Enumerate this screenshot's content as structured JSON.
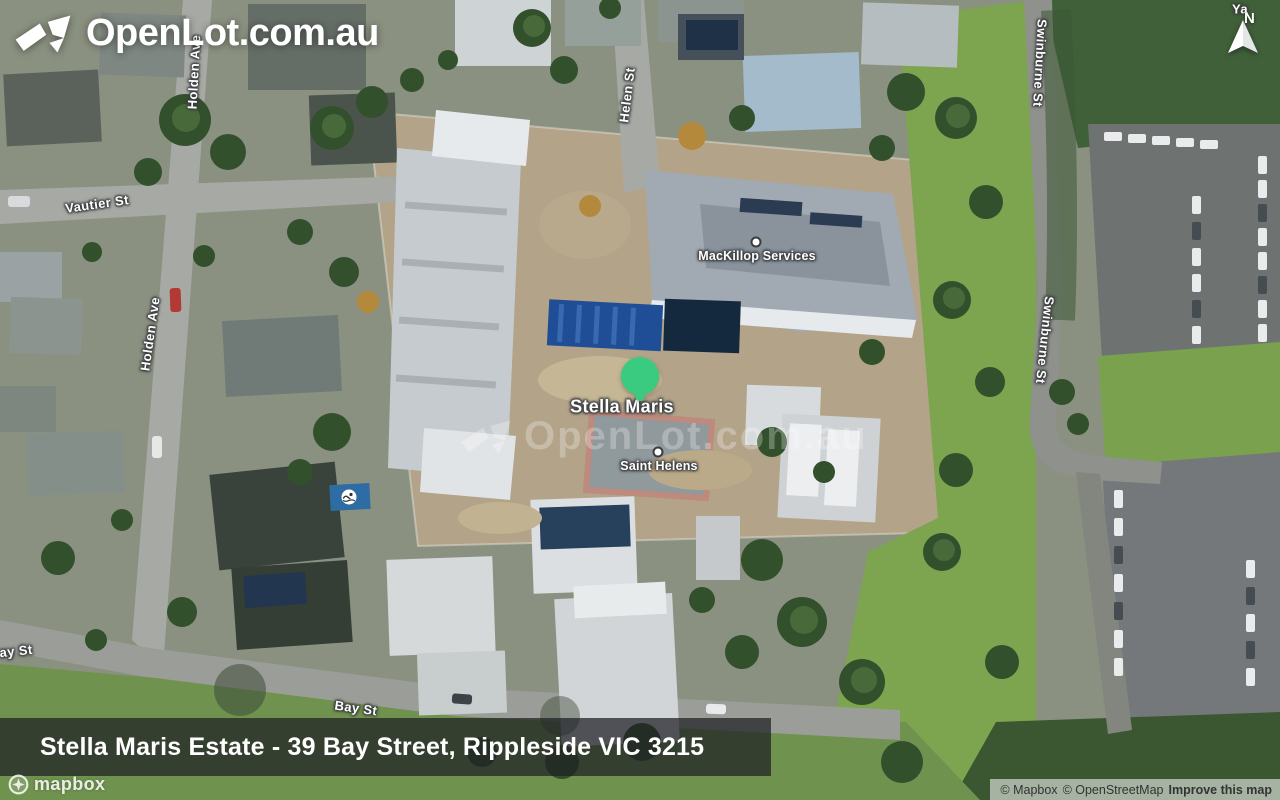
{
  "branding": {
    "logo_text": "OpenLot.com.au",
    "watermark_text": "OpenLot.com.au"
  },
  "compass": {
    "label": "N"
  },
  "marker": {
    "label": "Stella Maris",
    "color": "#3acb81"
  },
  "pois": [
    {
      "label": "MacKillop Services"
    },
    {
      "label": "Saint Helens"
    }
  ],
  "streets": [
    {
      "label": "Vautier St"
    },
    {
      "label": "Holden Ave"
    },
    {
      "label": "Holden Ave"
    },
    {
      "label": "Helen St"
    },
    {
      "label": "Swinburne St"
    },
    {
      "label": "Swinburne St"
    },
    {
      "label": "Bay St"
    },
    {
      "label": "ay St"
    },
    {
      "label": "Ya"
    }
  ],
  "banner": {
    "title": "Stella Maris Estate - 39 Bay Street, Rippleside VIC 3215"
  },
  "map_provider": {
    "name": "mapbox"
  },
  "attribution": {
    "mapbox": "© Mapbox",
    "osm": "© OpenStreetMap",
    "improve": "Improve this map"
  },
  "colors": {
    "marker_green": "#3acb81",
    "banner_bg": "rgba(30,31,36,0.72)",
    "label_halo": "#3a3c3e"
  }
}
